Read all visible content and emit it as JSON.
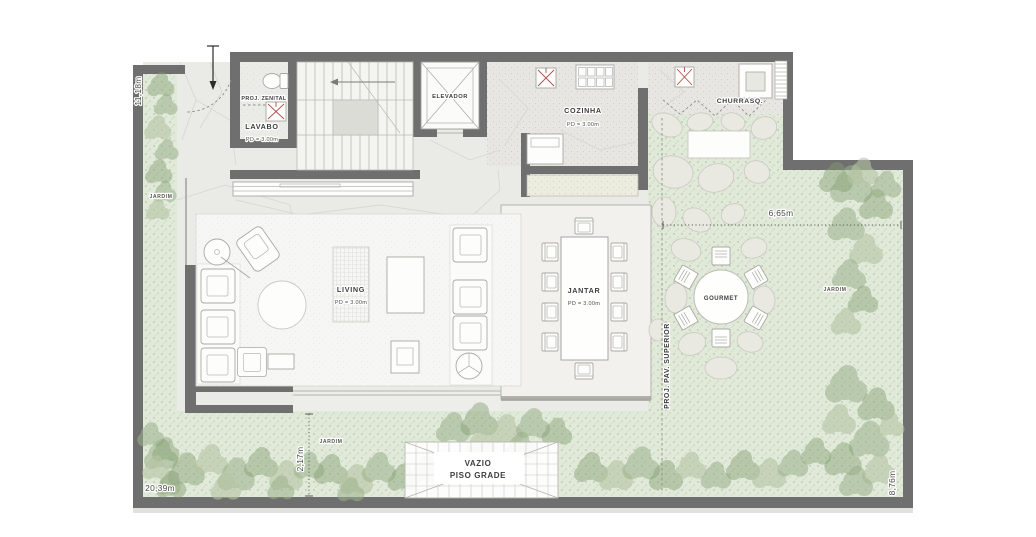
{
  "labels": {
    "proj_zenital": "PROJ. ZENITAL",
    "lavabo": "LAVABO",
    "lavabo_pd": "PD = 3.00m",
    "elevador": "ELEVADOR",
    "cozinha": "COZINHA",
    "cozinha_pd": "PD = 3.00m",
    "churrasq": "CHURRASQ.",
    "living": "LIVING",
    "living_pd": "PD = 3.00m",
    "jantar": "JANTAR",
    "jantar_pd": "PD = 3.00m",
    "gourmet": "GOURMET",
    "jardim_left": "JARDIM",
    "jardim_right": "JARDIM",
    "jardim_bottom": "JARDIM",
    "vazio_line1": "VAZIO",
    "vazio_line2": "PISO GRADE",
    "proj_pav_superior": "PROJ. PAV. SUPERIOR"
  },
  "dimensions": {
    "left_height": "11,18m",
    "bottom_width": "20,39m",
    "garden_width": "6,65m",
    "garden_strip_depth": "2,17m",
    "right_height": "8,76m"
  },
  "colors": {
    "wall": "#6f6f6f",
    "floor": "#eaeae7",
    "living_floor": "#f6f6f4",
    "garden": "#e1e9d9",
    "tree": "#9cb18b",
    "stone": "#e9e9e2",
    "fixture_mark": "#b05252"
  }
}
